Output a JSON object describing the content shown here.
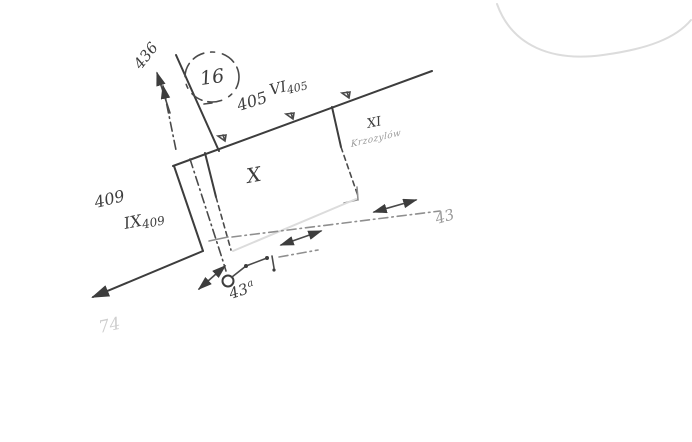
{
  "sketch": {
    "labels": {
      "road_arrow_number": "436",
      "circled_sheet_number": "16",
      "boundary_number": "405",
      "parcel_vi_roman": "VI",
      "parcel_vi_sub": "405",
      "parcel_x": "X",
      "parcel_xi_roman": "XI",
      "parcel_xi_name": "Krzozylów",
      "number_409": "409",
      "parcel_ix_roman": "IX",
      "parcel_ix_sub": "409",
      "lane_number": "43",
      "point_number": "43",
      "point_suffix": "a",
      "ghost_number": "74"
    },
    "colors": {
      "ink": "#3d3d3d",
      "mid_gray": "#8f8f8f",
      "faint_text": "#9a9a9a",
      "ghost": "#dcdcdc",
      "paper": "#ffffff"
    }
  }
}
